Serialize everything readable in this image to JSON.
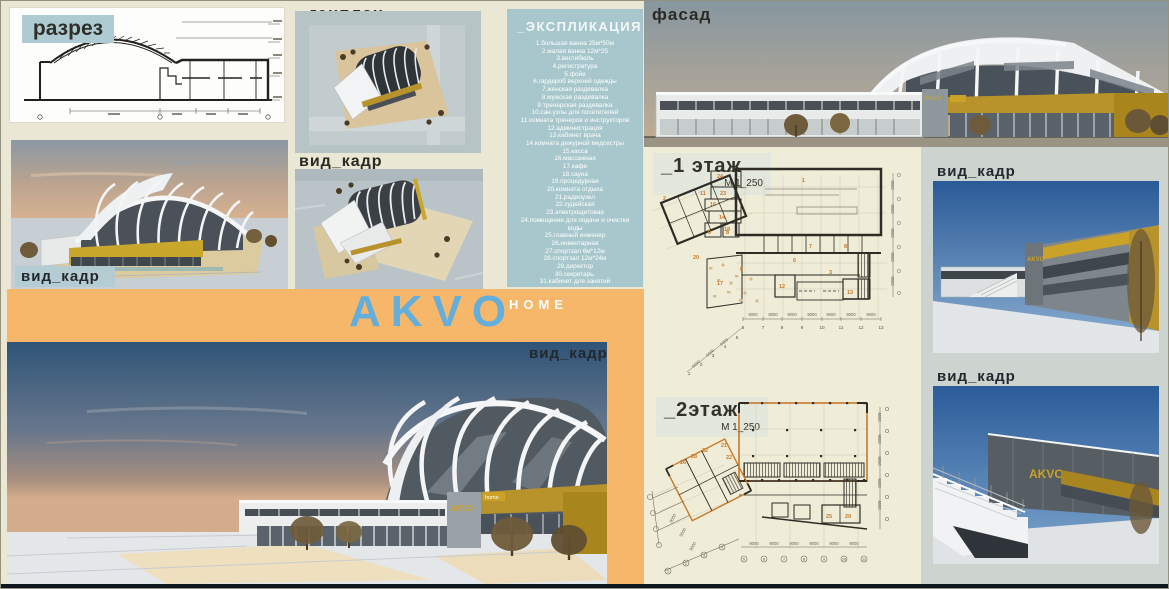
{
  "view_label": "вид_кадр",
  "section": {
    "label": "разрез"
  },
  "genplan": {
    "label": "_генплан"
  },
  "facade": {
    "label": "фасад"
  },
  "logo": {
    "akvo": "AKVO",
    "home": "HOME"
  },
  "building_sign": {
    "akvo": "AKVO",
    "home": "home"
  },
  "explication": {
    "title": "_ЭКСПЛИКАЦИЯ",
    "items": [
      "1.большая ванна 25м*50м",
      "2.малая ванна 12м*25",
      "3.вестибюль",
      "4.регистратура",
      "5.фойе",
      "6.гардероб верхней одежды",
      "7.женская раздевалка",
      "8.мужская раздевалка",
      "9.тренерская раздевалка",
      "10.сан.узлы для посетителей",
      "11.комната тренеров и инструкторов",
      "12.администрация",
      "13.кабинет врача",
      "14.комната дежурной медсестры",
      "15.касса",
      "16.массажная",
      "17.кафе",
      "18.сауна",
      "19.процедурная",
      "20.комната отдыха",
      "21.радиоузел",
      "22.судейская",
      "23.электрощитовая",
      "24.помещение для подачи и очистки воды",
      "25.главный инженер",
      "26.инвентарная",
      "27.спортзал 6м*12м",
      "28.спортзал 12м*24м",
      "29.директор",
      "30.секретарь.",
      "31.кабинет для занятий"
    ]
  },
  "floor1": {
    "title": "_1 этаж",
    "scale": "М 1_250"
  },
  "floor2": {
    "title": "_2этаж",
    "scale": "М 1_250"
  },
  "plans": {
    "dim": "9000",
    "floor1_rooms": [
      "1",
      "2",
      "24",
      "23",
      "16",
      "14",
      "18",
      "11",
      "9",
      "8",
      "7",
      "8",
      "20",
      "5",
      "17",
      "12",
      "6",
      "3",
      "13"
    ],
    "floor1_grid": [
      "6",
      "7",
      "8",
      "9",
      "10",
      "11",
      "12",
      "13"
    ],
    "floor1_diag": [
      "5",
      "4",
      "3",
      "2",
      "1"
    ],
    "floor2_rooms": [
      "21",
      "22",
      "32",
      "28",
      "26",
      "25",
      "29"
    ],
    "floor2_grid": [
      "5",
      "6",
      "7",
      "8",
      "9",
      "10",
      "11"
    ],
    "floor2_diag": [
      "4",
      "3",
      "2",
      "1"
    ]
  },
  "colors": {
    "accent_orange": "#F6B76B",
    "panel_teal": "#A7C7CC",
    "logo_blue": "#64AEDC",
    "gold": "#B8922B"
  }
}
